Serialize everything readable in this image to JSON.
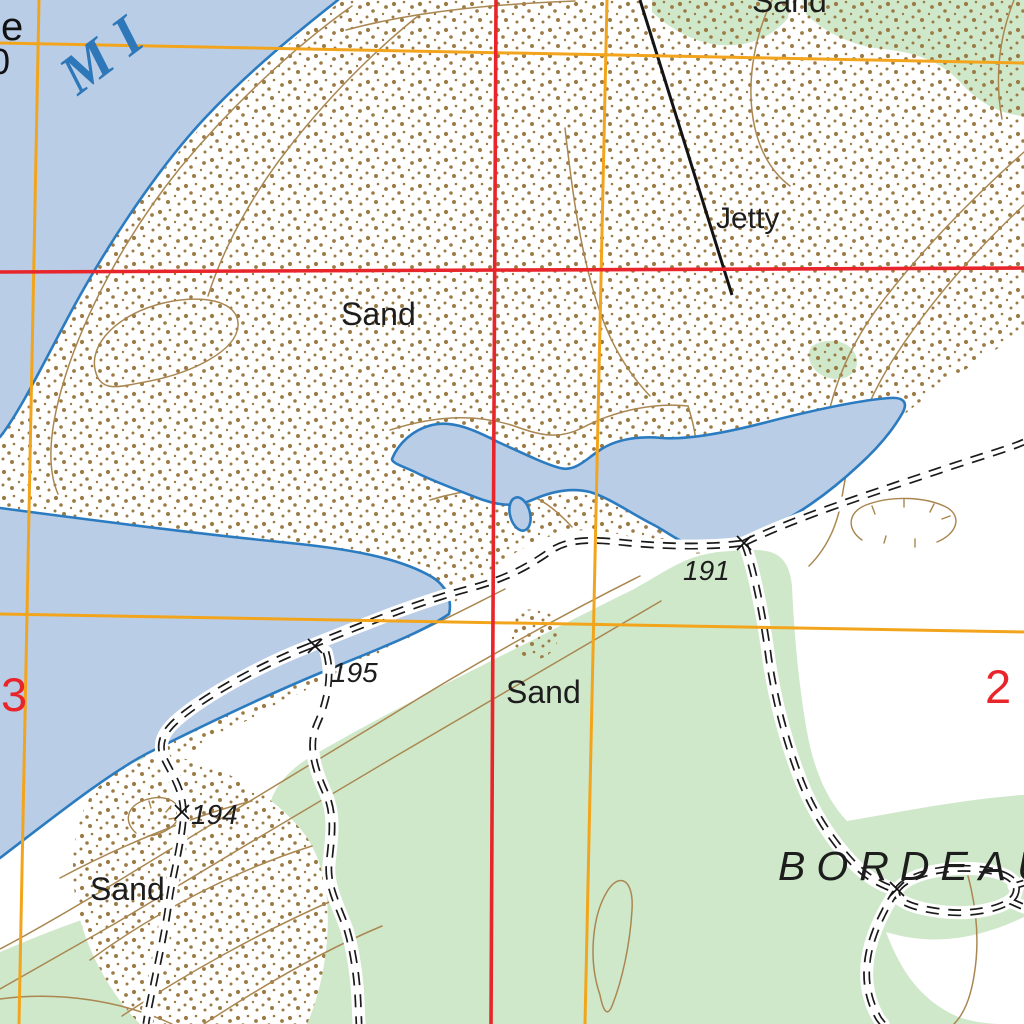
{
  "map_type": "topographic-map",
  "labels": {
    "water_name_partial": "MI",
    "edge_text_top": "e",
    "edge_text_bottom": "0",
    "jetty": "Jetty",
    "sand_top": "Sand",
    "sand_main": "Sand",
    "sand_mid": "Sand",
    "sand_low": "Sand",
    "place_name": "BORDEAUX",
    "spot_heights": {
      "h191": "191",
      "h195": "195",
      "h194": "194"
    },
    "grid_number_left": "3",
    "grid_number_right": "2"
  },
  "colors": {
    "water_fill": "#b9cde7",
    "water_outline": "#2b7bc0",
    "vegetation": "#cfe8ca",
    "sand_stipple_dot": "#9b7a44",
    "contour": "#aa8751",
    "grid_red": "#e8252b",
    "grid_orange": "#f2a51c",
    "track": "#1a1a1a",
    "label_text": "#1d1d1d",
    "water_label_text": "#2e77b8"
  }
}
